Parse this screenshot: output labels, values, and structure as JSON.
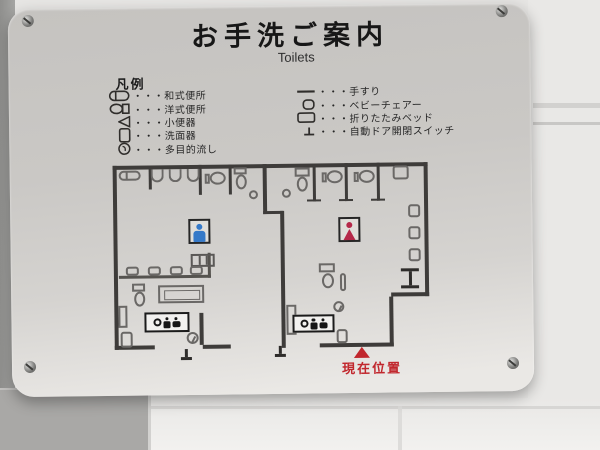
{
  "sign": {
    "title": "お手洗ご案内",
    "subtitle": "Toilets"
  },
  "legend": {
    "heading": "凡例",
    "left_items": [
      {
        "icon": "squat-toilet-icon",
        "label": "・・・和式便所"
      },
      {
        "icon": "western-toilet-icon",
        "label": "・・・洋式便所"
      },
      {
        "icon": "urinal-icon",
        "label": "・・・小便器"
      },
      {
        "icon": "washbasin-icon",
        "label": "・・・洗面器"
      },
      {
        "icon": "multipurpose-sink-icon",
        "label": "・・・多目的流し"
      }
    ],
    "right_items": [
      {
        "icon": "handrail-icon",
        "label": "・・・手すり"
      },
      {
        "icon": "baby-chair-icon",
        "label": "・・・ベビーチェアー"
      },
      {
        "icon": "folding-bed-icon",
        "label": "・・・折りたたみベッド"
      },
      {
        "icon": "auto-door-switch-icon",
        "label": "・・・自動ドア開閉スイッチ"
      }
    ]
  },
  "floor_plan": {
    "mens_sign_icon": "man-icon",
    "womens_sign_icon": "woman-icon",
    "accessible_icons": [
      "wheelchair-icon",
      "baby-changing-icon",
      "baby-chair-icon"
    ],
    "current_location_label": "現在位置"
  },
  "colors": {
    "plaque": "#cbc9c6",
    "wall_line": "#3e3c3a",
    "current_location_red": "#c1272d",
    "men_blue": "#3579c8",
    "women_red": "#b5294a"
  }
}
